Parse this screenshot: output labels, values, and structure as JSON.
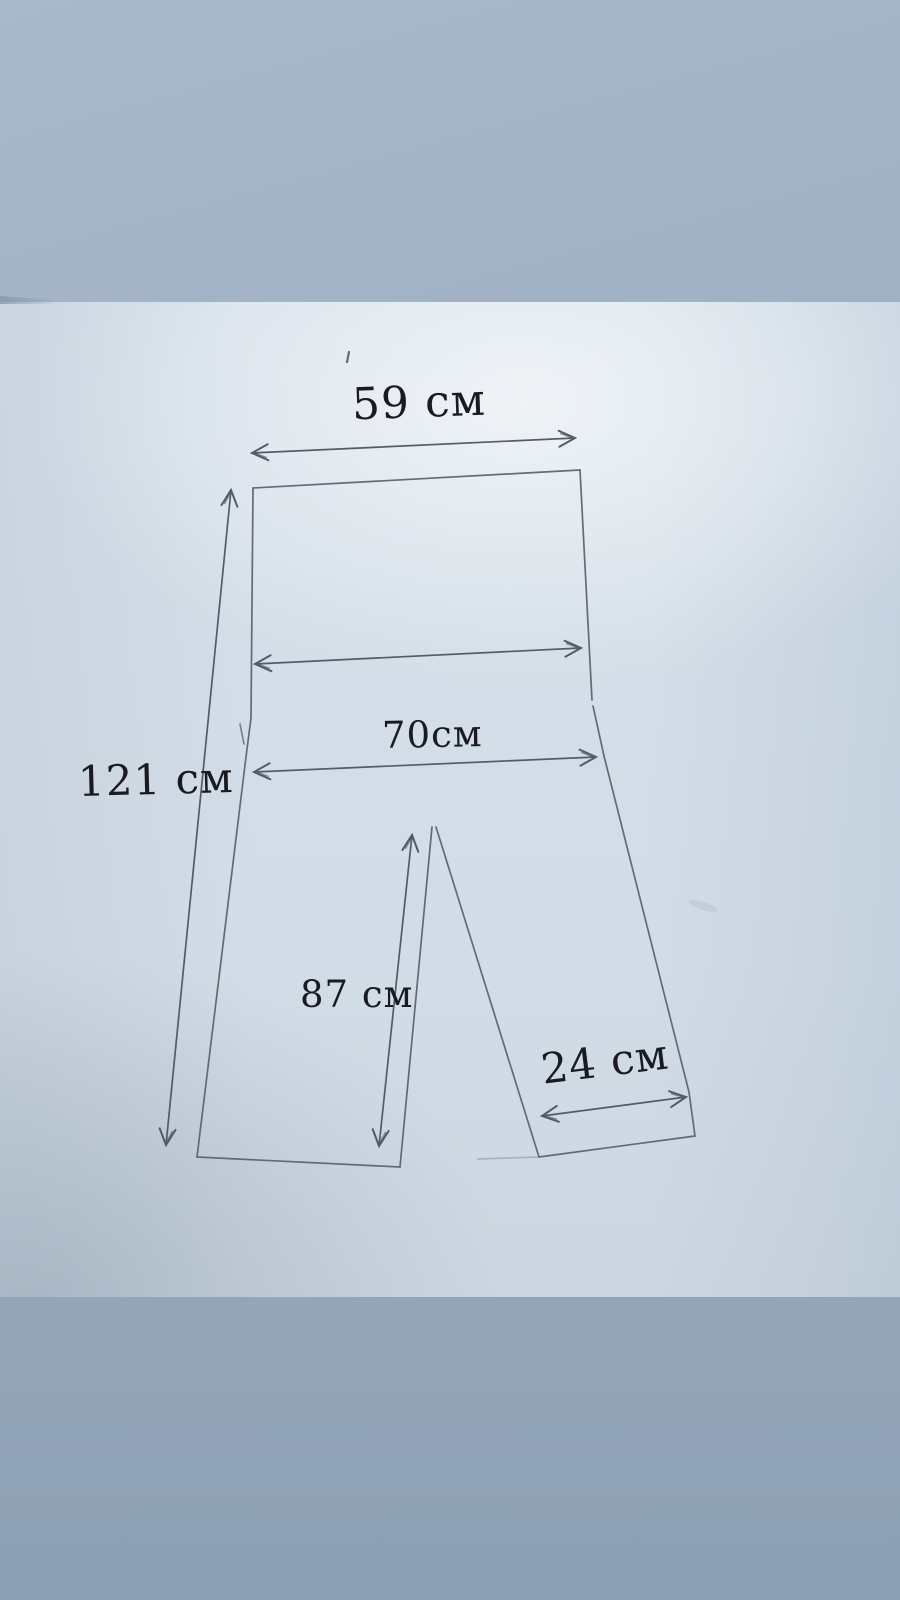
{
  "meta": {
    "scene": "photograph of a hand-drawn trousers pattern sketch on paper",
    "language": "ru",
    "unit_suffix": "см"
  },
  "colors": {
    "table_top": "#a4b4c6",
    "table_bottom": "#90a2b5",
    "paper": "#d3dde7",
    "paper_shadow": "#8a9cb0",
    "pencil": "#59616d",
    "arrow_pencil": "#4d5562",
    "ink_text": "#191b20"
  },
  "figure": {
    "kind": "garment-pattern-sketch",
    "shape": "trousers-outline",
    "drawn_elements": [
      "waist-rectangle",
      "left-leg",
      "right-leg",
      "waist-width-arrow-unlabeled"
    ]
  },
  "diagram": {
    "measurements": [
      {
        "id": "top-width",
        "label": "59 см",
        "value": 59,
        "unit": "см"
      },
      {
        "id": "total-length",
        "label": "121 см",
        "value": 121,
        "unit": "см"
      },
      {
        "id": "hip-width",
        "label": "70см",
        "value": 70,
        "unit": "см"
      },
      {
        "id": "inner-length",
        "label": "87 см",
        "value": 87,
        "unit": "см"
      },
      {
        "id": "hem-width",
        "label": "24 см",
        "value": 24,
        "unit": "см"
      }
    ]
  }
}
